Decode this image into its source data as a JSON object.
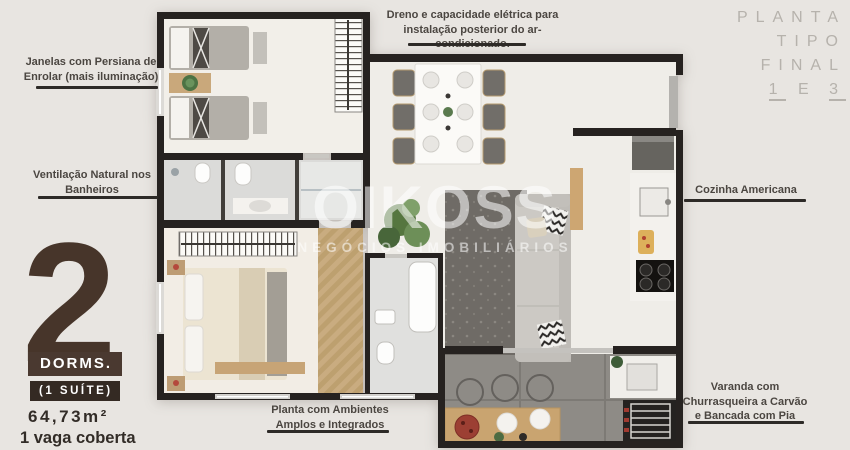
{
  "header": {
    "plan_type": {
      "line1": "PLANTA",
      "line2": "TIPO",
      "line3": "FINAL",
      "final_units": {
        "n1": "1",
        "sep": "E",
        "n2": "3"
      }
    }
  },
  "annotations": {
    "top": "Dreno e capacidade elétrica para instalação posterior do ar-condicionado.",
    "left_top": "Janelas com Persiana de Enrolar (mais iluminação)",
    "left_mid": "Ventilação Natural nos Banheiros",
    "right_top": "Cozinha Americana",
    "right_bottom": "Varanda com Churrasqueira a Carvão e Bancada com Pia",
    "bottom": "Planta com Ambientes Amplos e Integrados"
  },
  "unit_info": {
    "dorms_number": "2",
    "dorms_label": "DORMS.",
    "suite_badge": "(1 SUÍTE)",
    "area": "64,73m²",
    "parking": "1 vaga coberta"
  },
  "watermark": {
    "brand": "OIKOSS",
    "tagline": "NEGÓCIOS IMOBILIÁRIOS"
  },
  "colors": {
    "bg": "#e8e5e1",
    "text": "#4b4641",
    "underline": "#2d2a27",
    "muted": "#b6b2ac",
    "accent-brown": "#47352a",
    "box-brown": "#4a3930",
    "box-dark": "#342a23",
    "wall": "#262220",
    "watermark": "rgba(255,255,255,0.55)"
  }
}
